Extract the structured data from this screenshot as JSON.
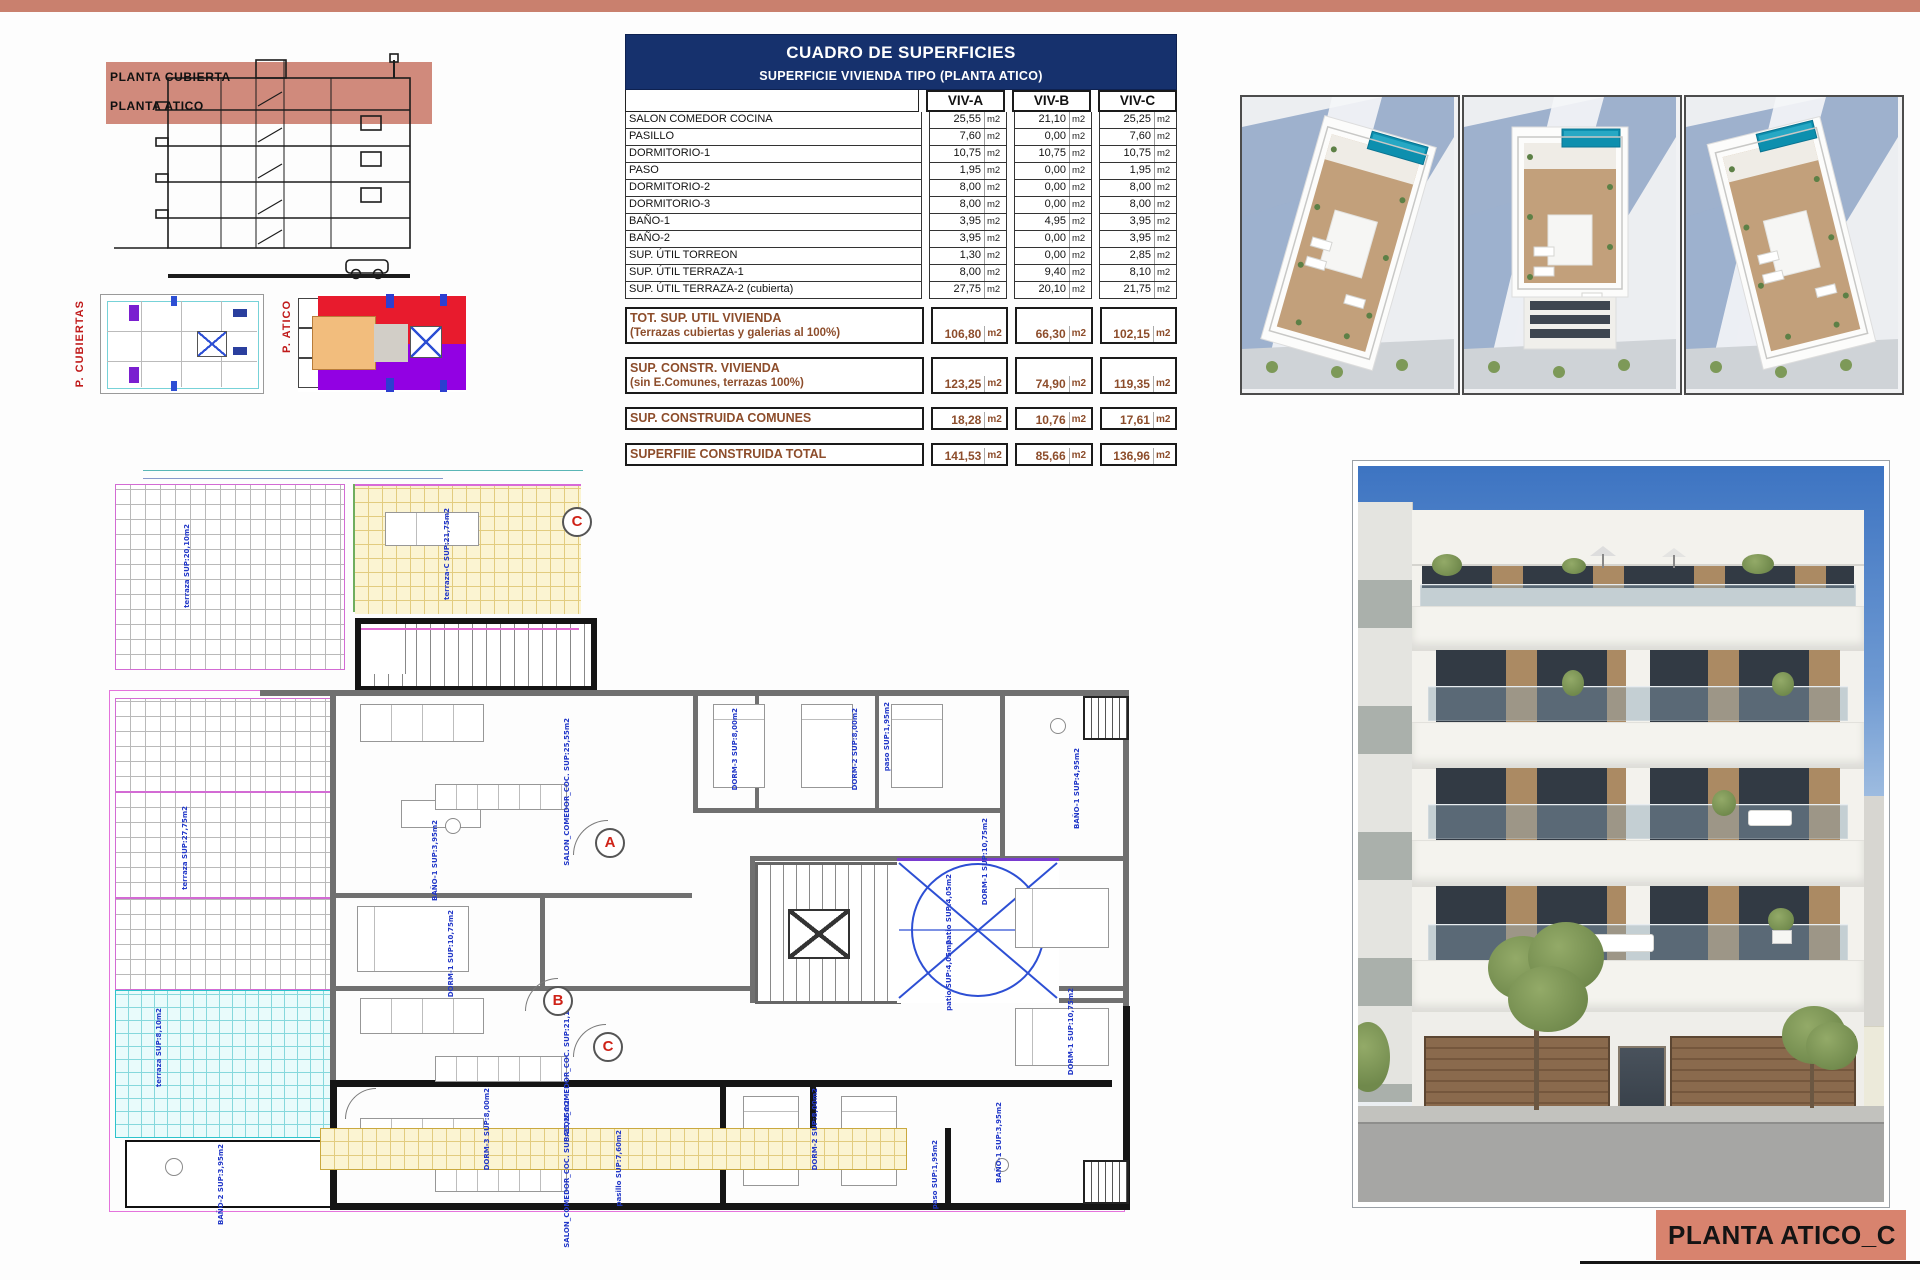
{
  "colors": {
    "accent_salmon": "#c9806e",
    "title_box_salmon": "#d8836e",
    "table_header_navy": "#16316d",
    "totals_brown": "#8d4d2b",
    "plan_label_blue": "#2238c8",
    "marker_red": "#cf2318"
  },
  "sheet": {
    "title": "PLANTA ATICO_C"
  },
  "section_drawing": {
    "labels": [
      "PLANTA CUBIERTA",
      "PLANTA ATICO"
    ]
  },
  "key_plans": {
    "left_label": "P. CUBIERTAS",
    "right_label": "P. ATICO"
  },
  "superficies_table": {
    "title": "CUADRO DE SUPERFICIES",
    "subtitle": "SUPERFICIE VIVIENDA TIPO  (PLANTA ATICO)",
    "unit": "m2",
    "columns": [
      "VIV-A",
      "VIV-B",
      "VIV-C"
    ],
    "rows": [
      {
        "label": "SALON COMEDOR COCINA",
        "values": [
          "25,55",
          "21,10",
          "25,25"
        ]
      },
      {
        "label": "PASILLO",
        "values": [
          "7,60",
          "0,00",
          "7,60"
        ]
      },
      {
        "label": "DORMITORIO-1",
        "values": [
          "10,75",
          "10,75",
          "10,75"
        ]
      },
      {
        "label": "PASO",
        "values": [
          "1,95",
          "0,00",
          "1,95"
        ]
      },
      {
        "label": "DORMITORIO-2",
        "values": [
          "8,00",
          "0,00",
          "8,00"
        ]
      },
      {
        "label": "DORMITORIO-3",
        "values": [
          "8,00",
          "0,00",
          "8,00"
        ]
      },
      {
        "label": "BAÑO-1",
        "values": [
          "3,95",
          "4,95",
          "3,95"
        ]
      },
      {
        "label": "BAÑO-2",
        "values": [
          "3,95",
          "0,00",
          "3,95"
        ]
      },
      {
        "label": "SUP. ÚTIL TORREON",
        "values": [
          "1,30",
          "0,00",
          "2,85"
        ]
      },
      {
        "label": "SUP. ÚTIL TERRAZA-1",
        "values": [
          "8,00",
          "9,40",
          "8,10"
        ]
      },
      {
        "label": "SUP. ÚTIL TERRAZA-2 (cubierta)",
        "values": [
          "27,75",
          "20,10",
          "21,75"
        ]
      }
    ],
    "totals": [
      {
        "label": "TOT. SUP. UTIL VIVIENDA",
        "sublabel": "(Terrazas cubiertas y galerias al 100%)",
        "values": [
          "106,80",
          "66,30",
          "102,15"
        ]
      },
      {
        "label": "SUP. CONSTR. VIVIENDA",
        "sublabel": "(sin E.Comunes, terrazas 100%)",
        "values": [
          "123,25",
          "74,90",
          "119,35"
        ]
      },
      {
        "label": "SUP. CONSTRUIDA COMUNES",
        "sublabel": "",
        "values": [
          "18,28",
          "10,76",
          "17,61"
        ]
      },
      {
        "label": "SUPERFIIE CONSTRUIDA TOTAL",
        "sublabel": "",
        "values": [
          "141,53",
          "85,66",
          "136,96"
        ]
      }
    ]
  },
  "floor_plan": {
    "markers": [
      "A",
      "B",
      "C"
    ],
    "labels": [
      {
        "id": "terraza_left",
        "text": "terraza SUP:27,75m2"
      },
      {
        "id": "terraza_cyan",
        "text": "terraza SUP:8,10m2"
      },
      {
        "id": "salon_a",
        "text": "SALON_COMEDOR_COC. SUP:25,55m2"
      },
      {
        "id": "dorm1_a",
        "text": "DORM-1 SUP:10,75m2"
      },
      {
        "id": "bano1_a",
        "text": "BAÑO-1 SUP:3,95m2"
      },
      {
        "id": "paso_a",
        "text": "paso SUP:1,95m2"
      },
      {
        "id": "dorm3_a",
        "text": "DORM-3 SUP:8,00m2"
      },
      {
        "id": "dorm2_a",
        "text": "DORM-2 SUP:8,00m2"
      },
      {
        "id": "dorm1_b",
        "text": "DORM-1 SUP:10,75m2"
      },
      {
        "id": "bano1_b",
        "text": "BAÑO-1 SUP:4,95m2"
      },
      {
        "id": "salon_b",
        "text": "SALON_COMEDOR_COC. SUP:21,10m2"
      },
      {
        "id": "dorm1_c",
        "text": "DORM-1 SUP:10,75m2"
      },
      {
        "id": "salon_c",
        "text": "SALON_COMEDOR_COC. SUP:25,25m2"
      },
      {
        "id": "dorm3_c",
        "text": "DORM-3 SUP:8,00m2"
      },
      {
        "id": "dorm2_c",
        "text": "DORM-2 SUP:8,00m2"
      },
      {
        "id": "bano2_c",
        "text": "BAÑO-2 SUP:3,95m2"
      },
      {
        "id": "pasillo_c",
        "text": "pasillo SUP:7,60m2"
      },
      {
        "id": "patio_top",
        "text": "patio SUP:4,05m2"
      },
      {
        "id": "patio_bot",
        "text": "patio SUP:4,05m2"
      },
      {
        "id": "paso_c",
        "text": "paso SUP:1,95m2"
      },
      {
        "id": "bano1_c",
        "text": "BAÑO-1 SUP:3,95m2"
      }
    ]
  },
  "roof_plan": {
    "marker": "C",
    "labels": [
      {
        "id": "roof_left",
        "text": "terraza SUP:20,10m2"
      },
      {
        "id": "roof_yellow",
        "text": "terraza-C SUP:21,75m2"
      }
    ]
  }
}
